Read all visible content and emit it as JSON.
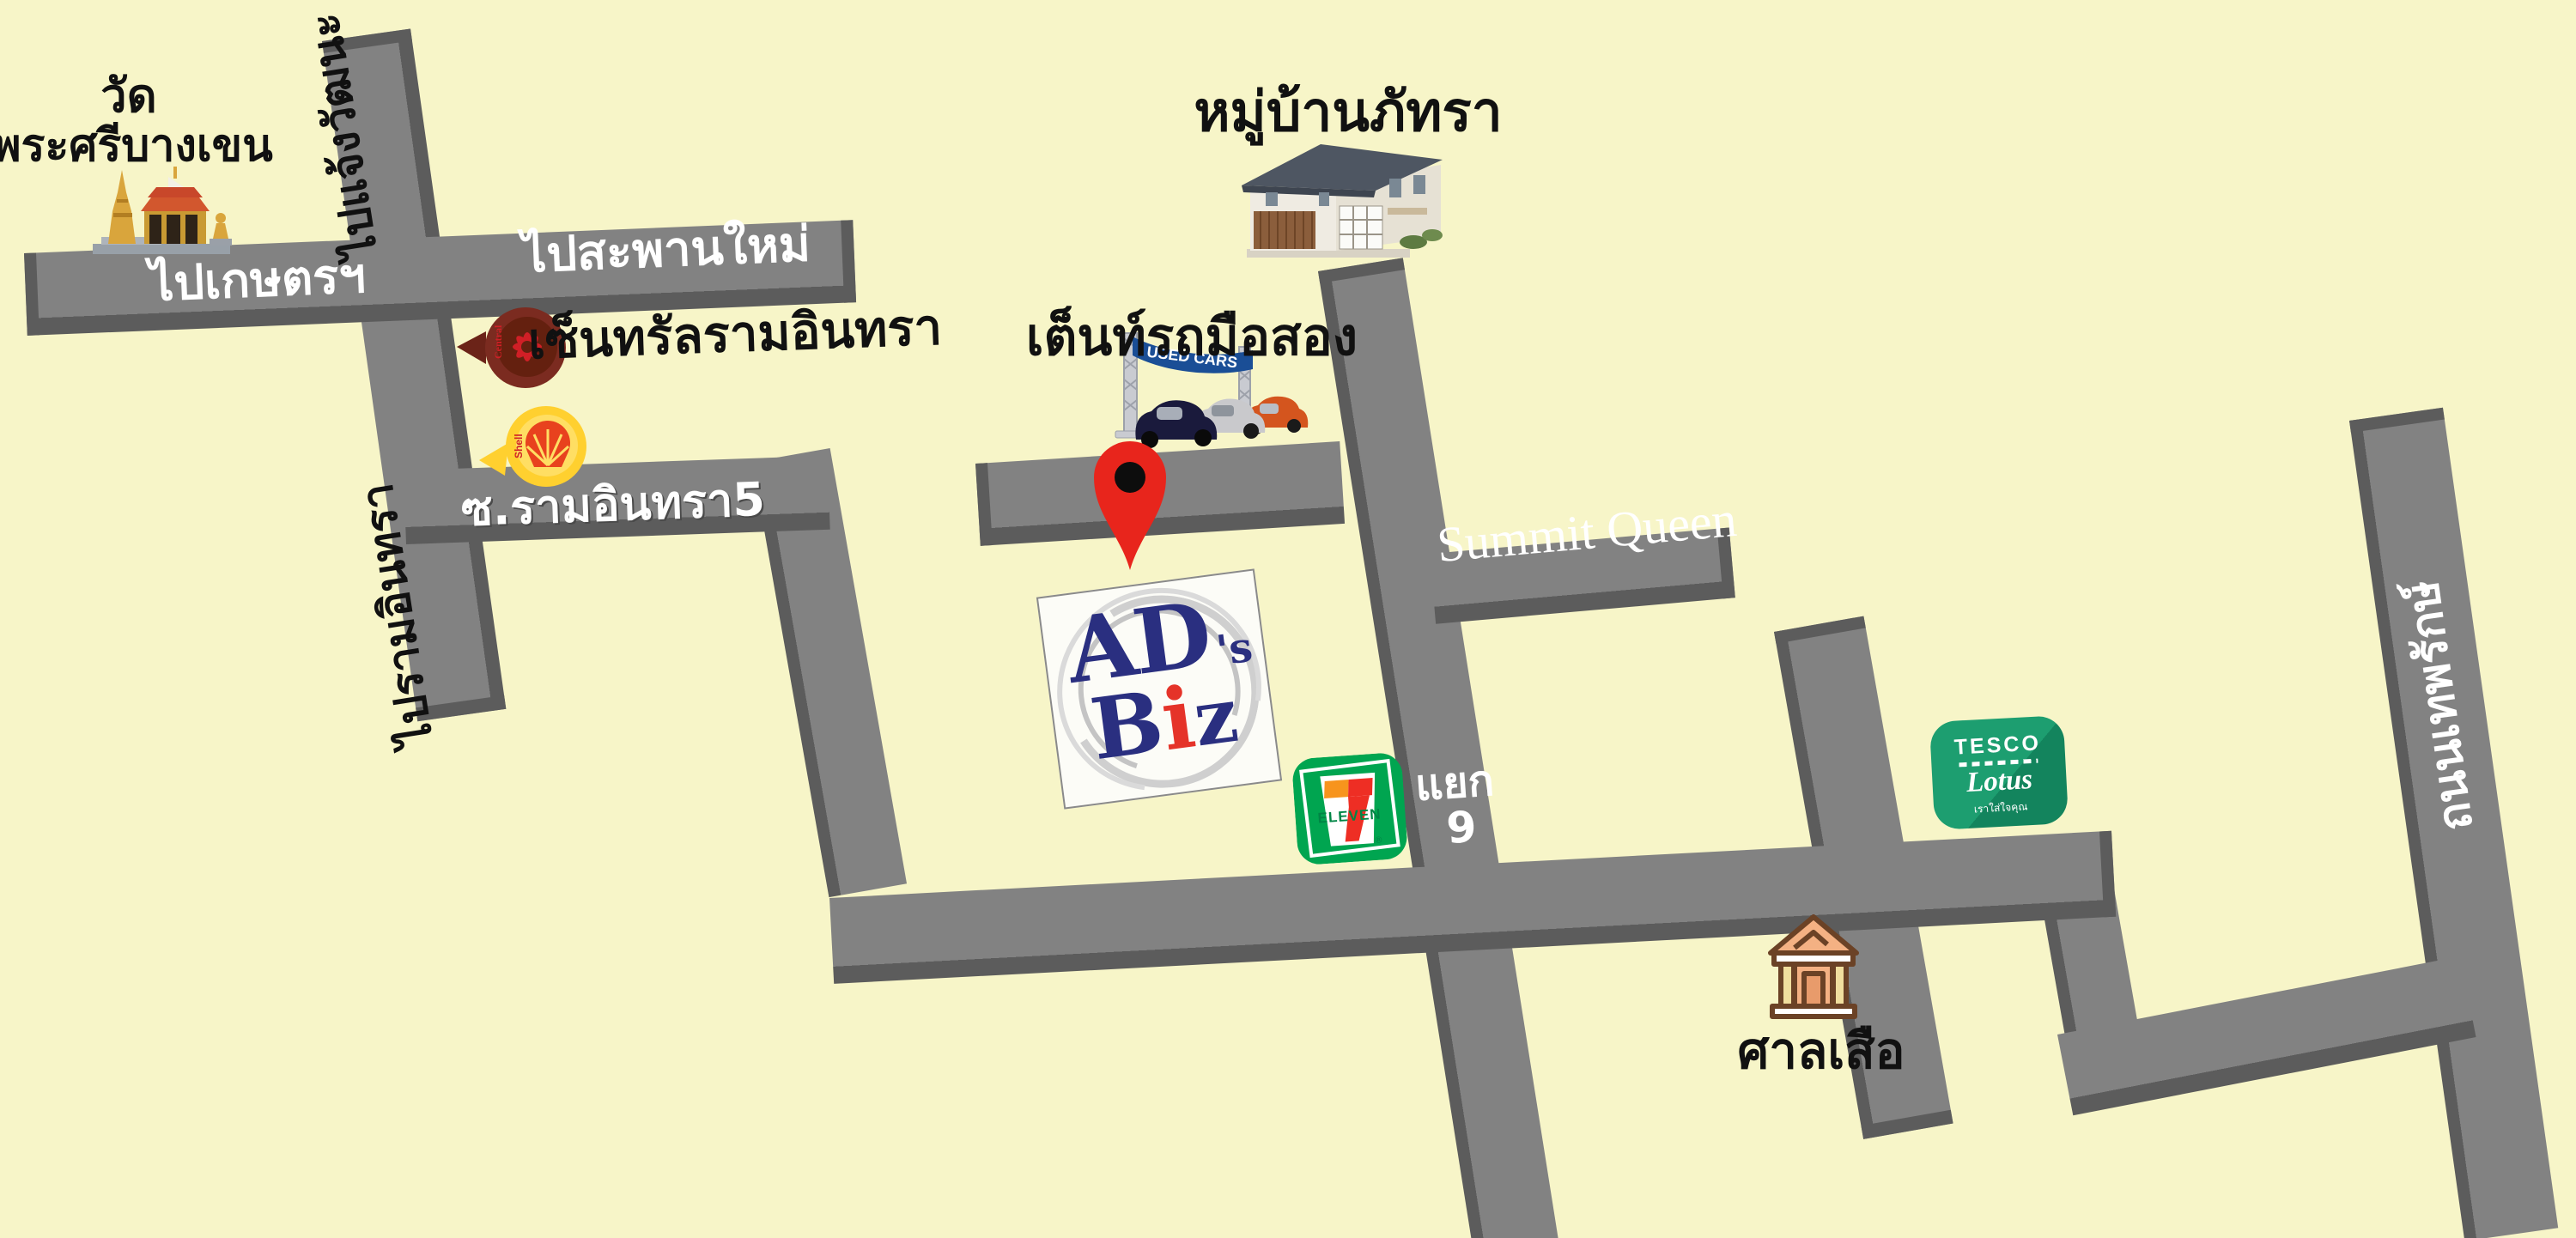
{
  "map": {
    "background_color": "#F7F5C8",
    "road_color": "#828282",
    "road_edge_color": "#5C5C5C"
  },
  "labels": {
    "temple_line1": "วัด",
    "temple_line2": "พระศรีบางเขน",
    "to_chaengwattana": "ไปแจ้งวัฒนะ",
    "to_kaset": "ไปเกษตรฯ",
    "to_saphan_mai": "ไปสะพานใหม่",
    "soi_ramintra5": "ซ.รามอินทรา5",
    "to_ramintra": "ไปรามอินทรา",
    "central_ramintra": "เซ็นทรัลรามอินทรา",
    "mooban_phatra": "หมู่บ้านภัทรา",
    "used_car_tent": "เต็นท์รถมือสอง",
    "summit_queen": "Summit Queen",
    "junction_word": "แยก",
    "junction_number": "9",
    "sala_suea": "ศาลเสือ",
    "thep_rak_road": "ถนนเทพรักษ์"
  },
  "logos": {
    "central": {
      "brand": "Central",
      "circle_color": "#7B2B20",
      "emblem_color": "#D01F26"
    },
    "shell": {
      "brand": "Shell",
      "circle_color": "#FFD02F",
      "emblem_color": "#E8421E"
    },
    "used_cars_banner": {
      "text": "USED CARS",
      "banner_color": "#1A4E96"
    },
    "seven_eleven": {
      "numeral": "7",
      "word": "ELEVEN",
      "green": "#00A550",
      "orange": "#F7941D",
      "red": "#EE2E24"
    },
    "tesco": {
      "line1": "TESCO",
      "line2": "Lotus",
      "line3": "เราใส่ใจคุณ",
      "green": "#1D9E70"
    },
    "ads_biz": {
      "ad": "AD",
      "apos": "'s",
      "b": "B",
      "i": "i",
      "z": "z",
      "navy": "#2A2F80",
      "red": "#E53329"
    },
    "map_pin_color": "#E8251C"
  }
}
